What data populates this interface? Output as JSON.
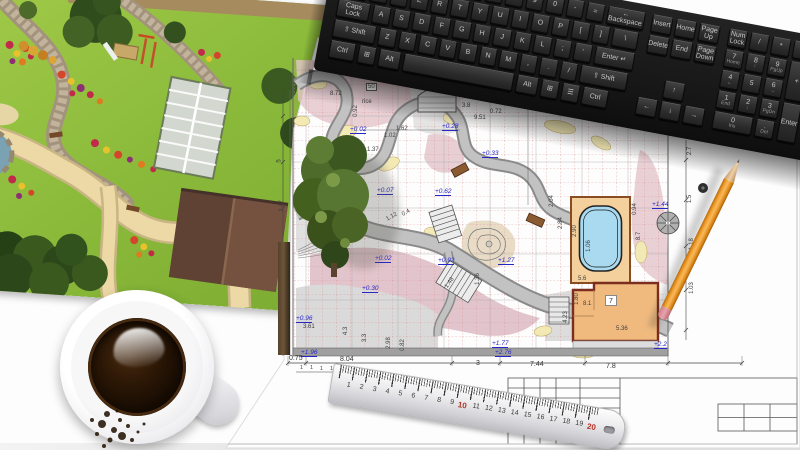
{
  "scene": {
    "description": "Top view of a landscape designer's desk: 3D garden visualization print, garden blueprint with dimensions, computer keyboard, cup of black coffee, steel ruler and orange pencil"
  },
  "keyboard": {
    "number_row": [
      "~",
      "1",
      "2",
      "3",
      "4",
      "5",
      "6",
      "7",
      "8",
      "9",
      "0",
      "-",
      "=",
      {
        "t": "← Backspace",
        "w": 38
      }
    ],
    "tab_row": [
      {
        "t": "Tab",
        "w": 27
      },
      "Q",
      "W",
      "E",
      "R",
      "T",
      "Y",
      "U",
      "I",
      "O",
      "P",
      "[",
      "]",
      {
        "t": "\\",
        "w": 26
      }
    ],
    "caps_row": [
      {
        "t": "Caps Lock",
        "w": 33
      },
      "A",
      "S",
      "D",
      "F",
      "G",
      "H",
      "J",
      "K",
      "L",
      ";",
      "'",
      {
        "t": "Enter ↵",
        "w": 40
      }
    ],
    "shift_row": [
      {
        "t": "⇧ Shift",
        "w": 43
      },
      "Z",
      "X",
      "C",
      "V",
      "B",
      "N",
      "M",
      ",",
      ".",
      "/",
      {
        "t": "⇧ Shift",
        "w": 48
      }
    ],
    "ctrl_row": [
      {
        "t": "Ctrl",
        "w": 26
      },
      {
        "t": "⊞",
        "w": 18
      },
      {
        "t": "Alt",
        "w": 22
      },
      {
        "t": "",
        "w": 112
      },
      {
        "t": "Alt",
        "w": 22
      },
      {
        "t": "⊞",
        "w": 18
      },
      {
        "t": "☰",
        "w": 18
      },
      {
        "t": "Ctrl",
        "w": 26
      }
    ],
    "nav_top": [
      {
        "t": "Insert",
        "w": 21
      },
      {
        "t": "Home",
        "w": 21
      },
      {
        "t": "Page Up",
        "w": 21
      }
    ],
    "nav_bottom": [
      {
        "t": "Delete",
        "w": 21
      },
      {
        "t": "End",
        "w": 21
      },
      {
        "t": "Page Down",
        "w": 21
      }
    ],
    "arrow_up": [
      {
        "t": "↑",
        "w": 21
      }
    ],
    "arrow_row": [
      {
        "t": "←",
        "w": 21
      },
      {
        "t": "↓",
        "w": 21
      },
      {
        "t": "→",
        "w": 21
      }
    ],
    "numpad_r1": [
      {
        "t": "Num Lock",
        "w": 19
      },
      {
        "t": "/",
        "w": 19
      },
      {
        "t": "*",
        "w": 19
      },
      {
        "t": "-",
        "w": 19
      }
    ],
    "numpad_r2": [
      {
        "t": "7",
        "s": "Home",
        "w": 19
      },
      {
        "t": "8",
        "s": "↑",
        "w": 19
      },
      {
        "t": "9",
        "s": "PgUp",
        "w": 19
      },
      {
        "t": "+",
        "w": 19,
        "h": 39
      }
    ],
    "numpad_r3": [
      {
        "t": "4",
        "s": "←",
        "w": 19
      },
      {
        "t": "5",
        "w": 19
      },
      {
        "t": "6",
        "s": "→",
        "w": 19
      }
    ],
    "numpad_r4": [
      {
        "t": "1",
        "s": "End",
        "w": 19
      },
      {
        "t": "2",
        "s": "↓",
        "w": 19
      },
      {
        "t": "3",
        "s": "PgDn",
        "w": 19
      },
      {
        "t": "Enter",
        "w": 19,
        "h": 39
      }
    ],
    "numpad_r5": [
      {
        "t": "0",
        "s": "Ins",
        "w": 40
      },
      {
        "t": ".",
        "s": "Del",
        "w": 19
      }
    ]
  },
  "blueprint": {
    "room_label": "7",
    "elevations": [
      {
        "t": "+0.02",
        "x": 350,
        "y": 126
      },
      {
        "t": "+0.28",
        "x": 442,
        "y": 123
      },
      {
        "t": "+0.33",
        "x": 482,
        "y": 150
      },
      {
        "t": "+0.07",
        "x": 377,
        "y": 187
      },
      {
        "t": "+0.62",
        "x": 435,
        "y": 188
      },
      {
        "t": "+0.02",
        "x": 375,
        "y": 255
      },
      {
        "t": "+0.30",
        "x": 362,
        "y": 285
      },
      {
        "t": "+0.92",
        "x": 438,
        "y": 257
      },
      {
        "t": "+1.27",
        "x": 498,
        "y": 257
      },
      {
        "t": "+1.44",
        "x": 652,
        "y": 201
      },
      {
        "t": "+0.96",
        "x": 296,
        "y": 315
      },
      {
        "t": "+1.96",
        "x": 301,
        "y": 349
      },
      {
        "t": "+1.77",
        "x": 492,
        "y": 340
      },
      {
        "t": "+2.76",
        "x": 495,
        "y": 349
      },
      {
        "t": "+2.2",
        "x": 654,
        "y": 341
      }
    ],
    "dimensions": [
      {
        "t": "8.72",
        "x": 330,
        "y": 91
      },
      {
        "t": "0.92",
        "x": 350,
        "y": 108,
        "rot": -90
      },
      {
        "t": "1.62",
        "x": 396,
        "y": 126
      },
      {
        "t": "1.02",
        "x": 384,
        "y": 133
      },
      {
        "t": "1.37",
        "x": 367,
        "y": 147
      },
      {
        "t": "3.8",
        "x": 462,
        "y": 103
      },
      {
        "t": "9.51",
        "x": 474,
        "y": 115
      },
      {
        "t": "0.72",
        "x": 490,
        "y": 109
      },
      {
        "t": "2.7",
        "x": 522,
        "y": 92,
        "rot": -80
      },
      {
        "t": "2.12",
        "x": 538,
        "y": 83,
        "rot": -75
      },
      {
        "t": "2.28",
        "x": 531,
        "y": 70,
        "rot": -75
      },
      {
        "t": "1.18",
        "x": 645,
        "y": 88,
        "rot": -85
      },
      {
        "t": "1.15",
        "x": 654,
        "y": 93,
        "rot": -85
      },
      {
        "t": "0.94",
        "x": 629,
        "y": 206,
        "rot": -90
      },
      {
        "t": "8.7",
        "x": 635,
        "y": 233,
        "rot": -90
      },
      {
        "t": "1.06",
        "x": 583,
        "y": 243,
        "rot": -90
      },
      {
        "t": "2.90",
        "x": 569,
        "y": 228,
        "rot": -90
      },
      {
        "t": "2.84",
        "x": 555,
        "y": 220,
        "rot": -90
      },
      {
        "t": "2.47",
        "x": 276,
        "y": 203,
        "rot": -90
      },
      {
        "t": "5",
        "x": 278,
        "y": 158,
        "rot": -90
      },
      {
        "t": "4.3",
        "x": 342,
        "y": 328,
        "rot": -90
      },
      {
        "t": "3.3",
        "x": 361,
        "y": 335,
        "rot": -90
      },
      {
        "t": "2.98",
        "x": 383,
        "y": 340,
        "rot": -90
      },
      {
        "t": "0.82",
        "x": 397,
        "y": 342,
        "rot": -90
      },
      {
        "t": "1.48",
        "x": 444,
        "y": 280,
        "rot": -55
      },
      {
        "t": "3.61",
        "x": 303,
        "y": 324
      },
      {
        "t": "0.4",
        "x": 402,
        "y": 210,
        "rot": -30
      },
      {
        "t": "1.12",
        "x": 386,
        "y": 214,
        "rot": -30
      },
      {
        "t": "1.36",
        "x": 472,
        "y": 276,
        "rot": -90
      },
      {
        "t": "5.6",
        "x": 578,
        "y": 276
      },
      {
        "t": "8.1",
        "x": 583,
        "y": 301
      },
      {
        "t": "4.23",
        "x": 560,
        "y": 314,
        "rot": -90
      },
      {
        "t": "1.80",
        "x": 571,
        "y": 296,
        "rot": -90
      },
      {
        "t": "5.36",
        "x": 616,
        "y": 326
      },
      {
        "t": "2.04",
        "x": 546,
        "y": 198,
        "rot": -90
      },
      {
        "t": "2.7",
        "x": 686,
        "y": 148,
        "rot": -90
      },
      {
        "t": "1.5",
        "x": 686,
        "y": 196,
        "rot": -90
      },
      {
        "t": "1.18",
        "x": 686,
        "y": 241,
        "rot": -90
      },
      {
        "t": "1.03",
        "x": 686,
        "y": 285,
        "rot": -90
      },
      {
        "t": "rice",
        "x": 362,
        "y": 99
      },
      {
        "t": "50",
        "x": 366,
        "y": 83,
        "cls": "boxed"
      }
    ],
    "bottom_dimensions": [
      {
        "t": "0.75",
        "x": 289,
        "y": 355
      },
      {
        "t": "8.04",
        "x": 340,
        "y": 356
      },
      {
        "t": "3",
        "x": 476,
        "y": 360
      },
      {
        "t": "7.44",
        "x": 530,
        "y": 361
      },
      {
        "t": "7.8",
        "x": 606,
        "y": 363
      }
    ],
    "unit_ticks": [
      {
        "t": "1",
        "x": 300,
        "y": 366
      },
      {
        "t": "1",
        "x": 310,
        "y": 366
      },
      {
        "t": "1",
        "x": 320,
        "y": 367
      },
      {
        "t": "1",
        "x": 330,
        "y": 367
      }
    ]
  },
  "ruler": {
    "numbers": [
      "1",
      "2",
      "3",
      "4",
      "5",
      "6",
      "7",
      "8",
      "9",
      {
        "t": "10",
        "cls": "red"
      },
      "11",
      "12",
      "13",
      "14",
      "15",
      "16",
      "17",
      "18",
      "19",
      {
        "t": "20",
        "cls": "red"
      }
    ]
  }
}
